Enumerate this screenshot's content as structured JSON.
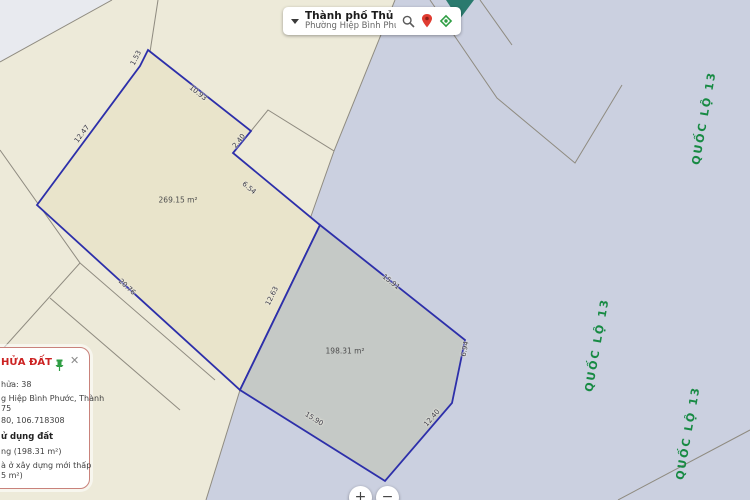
{
  "colors": {
    "road_zone": "#cbd0e0",
    "cadastral_zone": "#edead9",
    "parcel_a_fill": "#e9e4cb",
    "parcel_b_fill": "#c5c9c6",
    "selection_stroke": "#2d2faa",
    "parcel_line": "#8f8b80",
    "road_label_green": "#178a43",
    "panel_title_red": "#cc2222",
    "teal_feature": "#2a7a6e"
  },
  "search_bar": {
    "city": "Thành phố Thủ Đức",
    "ward": "Phường Hiệp Bình Phước",
    "icons": {
      "dropdown": "chevron-down",
      "search": "magnifier",
      "marker": "location-pin",
      "locate": "gps-locate"
    }
  },
  "map": {
    "parcels": [
      {
        "name": "parcel-a",
        "area": "269.15 m²"
      },
      {
        "name": "parcel-b",
        "area": "198.31 m²"
      }
    ],
    "labels": [
      {
        "cls": "edge",
        "text": "1.53",
        "x": 136,
        "y": 58,
        "r": -63
      },
      {
        "cls": "edge",
        "text": "10.93",
        "x": 198,
        "y": 93,
        "r": 38
      },
      {
        "cls": "edge",
        "text": "12.47",
        "x": 82,
        "y": 134,
        "r": -53
      },
      {
        "cls": "edge",
        "text": "2.40",
        "x": 239,
        "y": 141,
        "r": -51
      },
      {
        "cls": "edge",
        "text": "6.54",
        "x": 249,
        "y": 188,
        "r": 40
      },
      {
        "cls": "edge",
        "text": "20.76",
        "x": 127,
        "y": 287,
        "r": 42
      },
      {
        "cls": "edge",
        "text": "12.63",
        "x": 272,
        "y": 296,
        "r": -64
      },
      {
        "cls": "edge",
        "text": "15.91",
        "x": 391,
        "y": 282,
        "r": 38
      },
      {
        "cls": "edge",
        "text": "6.94",
        "x": 465,
        "y": 349,
        "r": -78
      },
      {
        "cls": "edge",
        "text": "15.90",
        "x": 314,
        "y": 419,
        "r": 32
      },
      {
        "cls": "edge",
        "text": "12.40",
        "x": 432,
        "y": 418,
        "r": -49
      },
      {
        "cls": "area",
        "text": "269.15 m²",
        "x": 178,
        "y": 200,
        "r": 0
      },
      {
        "cls": "area",
        "text": "198.31 m²",
        "x": 345,
        "y": 351,
        "r": 0
      },
      {
        "cls": "road",
        "text": "QUỐC LỘ 13",
        "x": 704,
        "y": 118,
        "r": -80
      },
      {
        "cls": "road",
        "text": "QUỐC LỘ 13",
        "x": 597,
        "y": 345,
        "r": -80
      },
      {
        "cls": "road",
        "text": "QUỐC LỘ 13",
        "x": 688,
        "y": 433,
        "r": -80
      }
    ]
  },
  "info_panel": {
    "title": "HỬA ĐẤT",
    "close": "✕",
    "lines": [
      "hửa: 38",
      "g Hiệp Bình Phước, Thành",
      "75",
      "80, 106.718308",
      "ử dụng đất",
      "ng (198.31 m²)",
      "à ở xây dựng mới thấp",
      "5 m²)"
    ]
  },
  "zoom_controls": {
    "zoom_in": "+",
    "zoom_out": "−"
  }
}
